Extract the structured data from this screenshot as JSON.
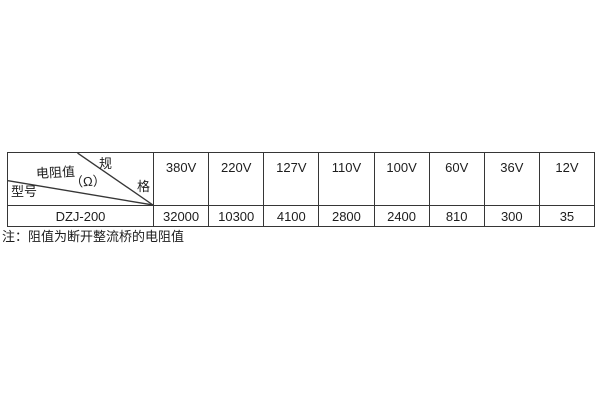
{
  "table": {
    "corner": {
      "spec_top": "规",
      "spec_bottom": "格",
      "resistance_label": "电阻值",
      "unit_label": "（Ω）",
      "model_label": "型号"
    },
    "columns": [
      "380V",
      "220V",
      "127V",
      "110V",
      "100V",
      "60V",
      "36V",
      "12V"
    ],
    "rows": [
      {
        "model": "DZJ-200",
        "values": [
          "32000",
          "10300",
          "4100",
          "2800",
          "2400",
          "810",
          "300",
          "35"
        ]
      }
    ]
  },
  "note": "注：阻值为断开整流桥的电阻值",
  "colors": {
    "background": "#ffffff",
    "border": "#363636",
    "text": "#1d1d1d"
  }
}
